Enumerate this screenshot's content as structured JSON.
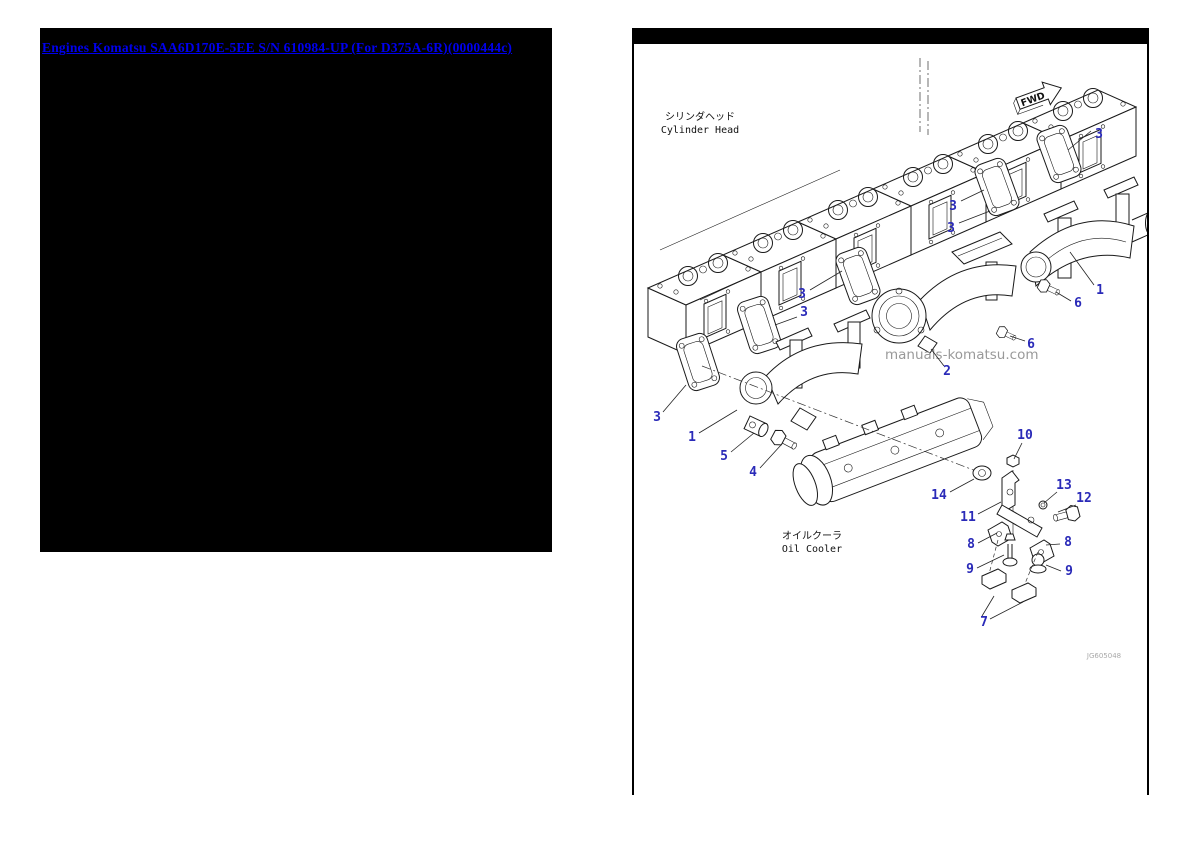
{
  "left_panel": {
    "title_link": "Engines Komatsu SAA6D170E-5EE S/N 610984-UP (For D375A-6R)(0000444c)"
  },
  "diagram": {
    "annotations": {
      "fwd_label": "FWD",
      "cylinder_head_jp": "シリンダヘッド",
      "cylinder_head_en": "Cylinder Head",
      "oil_cooler_jp": "オイルクーラ",
      "oil_cooler_en": "Oil Cooler",
      "watermark": "manuals-komatsu.com",
      "drawing_code": "JG605048"
    },
    "colors": {
      "callout_blue": "#2a2ab8",
      "link_blue": "#0000ee",
      "watermark_gray": "#8f8f8f"
    },
    "callouts": [
      {
        "label": "3",
        "tx": 1099,
        "ty": 138,
        "leaders": [
          [
            1091,
            131,
            1068,
            150
          ]
        ]
      },
      {
        "label": "3",
        "tx": 953,
        "ty": 210,
        "leaders": [
          [
            961,
            201,
            984,
            190
          ]
        ]
      },
      {
        "label": "3",
        "tx": 951,
        "ty": 232,
        "leaders": [
          [
            959,
            223,
            990,
            211
          ]
        ]
      },
      {
        "label": "3",
        "tx": 802,
        "ty": 298,
        "leaders": [
          [
            810,
            290,
            842,
            271
          ]
        ]
      },
      {
        "label": "3",
        "tx": 804,
        "ty": 316,
        "leaders": [
          [
            797,
            317,
            775,
            325
          ]
        ]
      },
      {
        "label": "3",
        "tx": 657,
        "ty": 421,
        "leaders": [
          [
            663,
            412,
            686,
            385
          ]
        ]
      },
      {
        "label": "1",
        "tx": 1100,
        "ty": 294,
        "leaders": [
          [
            1094,
            285,
            1070,
            252
          ]
        ]
      },
      {
        "label": "6",
        "tx": 1078,
        "ty": 307,
        "leaders": [
          [
            1071,
            301,
            1056,
            292
          ]
        ]
      },
      {
        "label": "6",
        "tx": 1031,
        "ty": 348,
        "leaders": [
          [
            1025,
            341,
            1010,
            336
          ]
        ]
      },
      {
        "label": "2",
        "tx": 947,
        "ty": 375,
        "leaders": [
          [
            944,
            366,
            931,
            349
          ]
        ]
      },
      {
        "label": "1",
        "tx": 692,
        "ty": 441,
        "leaders": [
          [
            699,
            433,
            737,
            410
          ]
        ]
      },
      {
        "label": "5",
        "tx": 724,
        "ty": 460,
        "leaders": [
          [
            731,
            452,
            754,
            433
          ]
        ]
      },
      {
        "label": "4",
        "tx": 753,
        "ty": 476,
        "leaders": [
          [
            760,
            468,
            781,
            445
          ]
        ]
      },
      {
        "label": "14",
        "tx": 939,
        "ty": 499,
        "leaders": [
          [
            950,
            492,
            974,
            479
          ]
        ]
      },
      {
        "label": "10",
        "tx": 1025,
        "ty": 439,
        "leaders": [
          [
            1022,
            443,
            1014,
            459
          ]
        ]
      },
      {
        "label": "11",
        "tx": 968,
        "ty": 521,
        "leaders": [
          [
            978,
            514,
            1001,
            502
          ]
        ]
      },
      {
        "label": "13",
        "tx": 1064,
        "ty": 489,
        "leaders": [
          [
            1057,
            492,
            1044,
            503
          ]
        ]
      },
      {
        "label": "12",
        "tx": 1084,
        "ty": 502,
        "leaders": [
          [
            1076,
            505,
            1058,
            512
          ]
        ]
      },
      {
        "label": "8",
        "tx": 971,
        "ty": 548,
        "leaders": [
          [
            978,
            543,
            997,
            533
          ]
        ]
      },
      {
        "label": "8",
        "tx": 1068,
        "ty": 546,
        "leaders": [
          [
            1060,
            544,
            1046,
            545
          ]
        ]
      },
      {
        "label": "9",
        "tx": 970,
        "ty": 573,
        "leaders": [
          [
            977,
            568,
            1004,
            555
          ]
        ]
      },
      {
        "label": "9",
        "tx": 1069,
        "ty": 575,
        "leaders": [
          [
            1061,
            571,
            1046,
            565
          ]
        ]
      },
      {
        "label": "7",
        "tx": 984,
        "ty": 626,
        "leaders": [
          [
            982,
            616,
            994,
            596
          ],
          [
            990,
            619,
            1023,
            602
          ]
        ]
      }
    ]
  }
}
